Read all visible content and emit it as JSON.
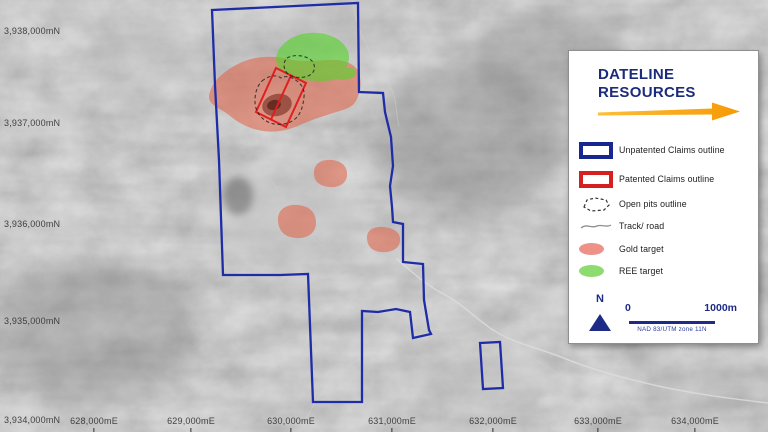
{
  "map": {
    "northings": [
      "3,938,000mN",
      "3,937,000mN",
      "3,936,000mN",
      "3,935,000mN",
      "3,934,000mN"
    ],
    "eastings": [
      "628,000mE",
      "629,000mE",
      "630,000mE",
      "631,000mE",
      "632,000mE",
      "633,000mE",
      "634,000mE"
    ]
  },
  "legend": {
    "brand_line1": "DATELINE",
    "brand_line2": "RESOURCES",
    "items": [
      {
        "label": "Unpatented Claims outline"
      },
      {
        "label": "Patented Claims outline"
      },
      {
        "label": "Open pits outline"
      },
      {
        "label": "Track/ road"
      },
      {
        "label": "Gold target"
      },
      {
        "label": "REE target"
      }
    ],
    "north": "N",
    "scale_start": "0",
    "scale_end": "1000m",
    "datum": "NAD 83/UTM zone 11N"
  },
  "colors": {
    "claims_blue": "#1e2da6",
    "patented_red": "#e01f1f",
    "gold_target": "#e25f44",
    "ree_target": "#55d32a",
    "brand_navy": "#1b2b7d",
    "arrow_orange": "#f69a05"
  }
}
